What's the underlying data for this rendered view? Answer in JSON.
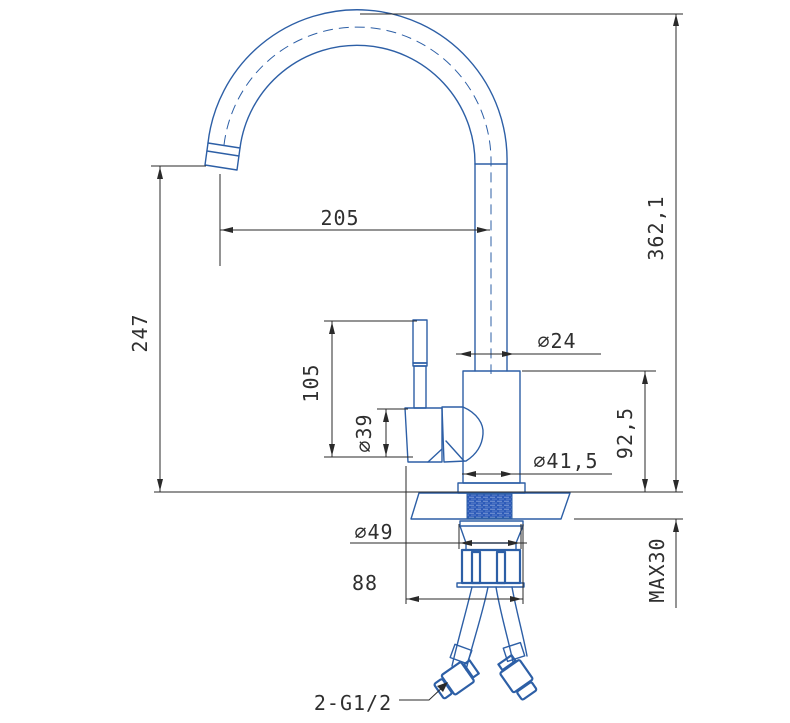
{
  "drawing": {
    "kind": "faucet-installation-technical-drawing",
    "colors": {
      "outline": "#2d5fa6",
      "dimension": "#2a2a2a",
      "thread_hatch": "#2c5ab8"
    },
    "dimensions": {
      "spout_reach": "205",
      "spout_tip_height": "247",
      "overall_height": "362,1",
      "riser_pipe_diameter": "∅24",
      "handle_height": "105",
      "handle_diameter": "∅39",
      "body_height": "92,5",
      "body_diameter": "∅41,5",
      "shank_diameter": "∅49",
      "base_depth": "88",
      "max_deck_thickness": "MAX30",
      "hose_thread_callout": "2-G1/2"
    }
  }
}
